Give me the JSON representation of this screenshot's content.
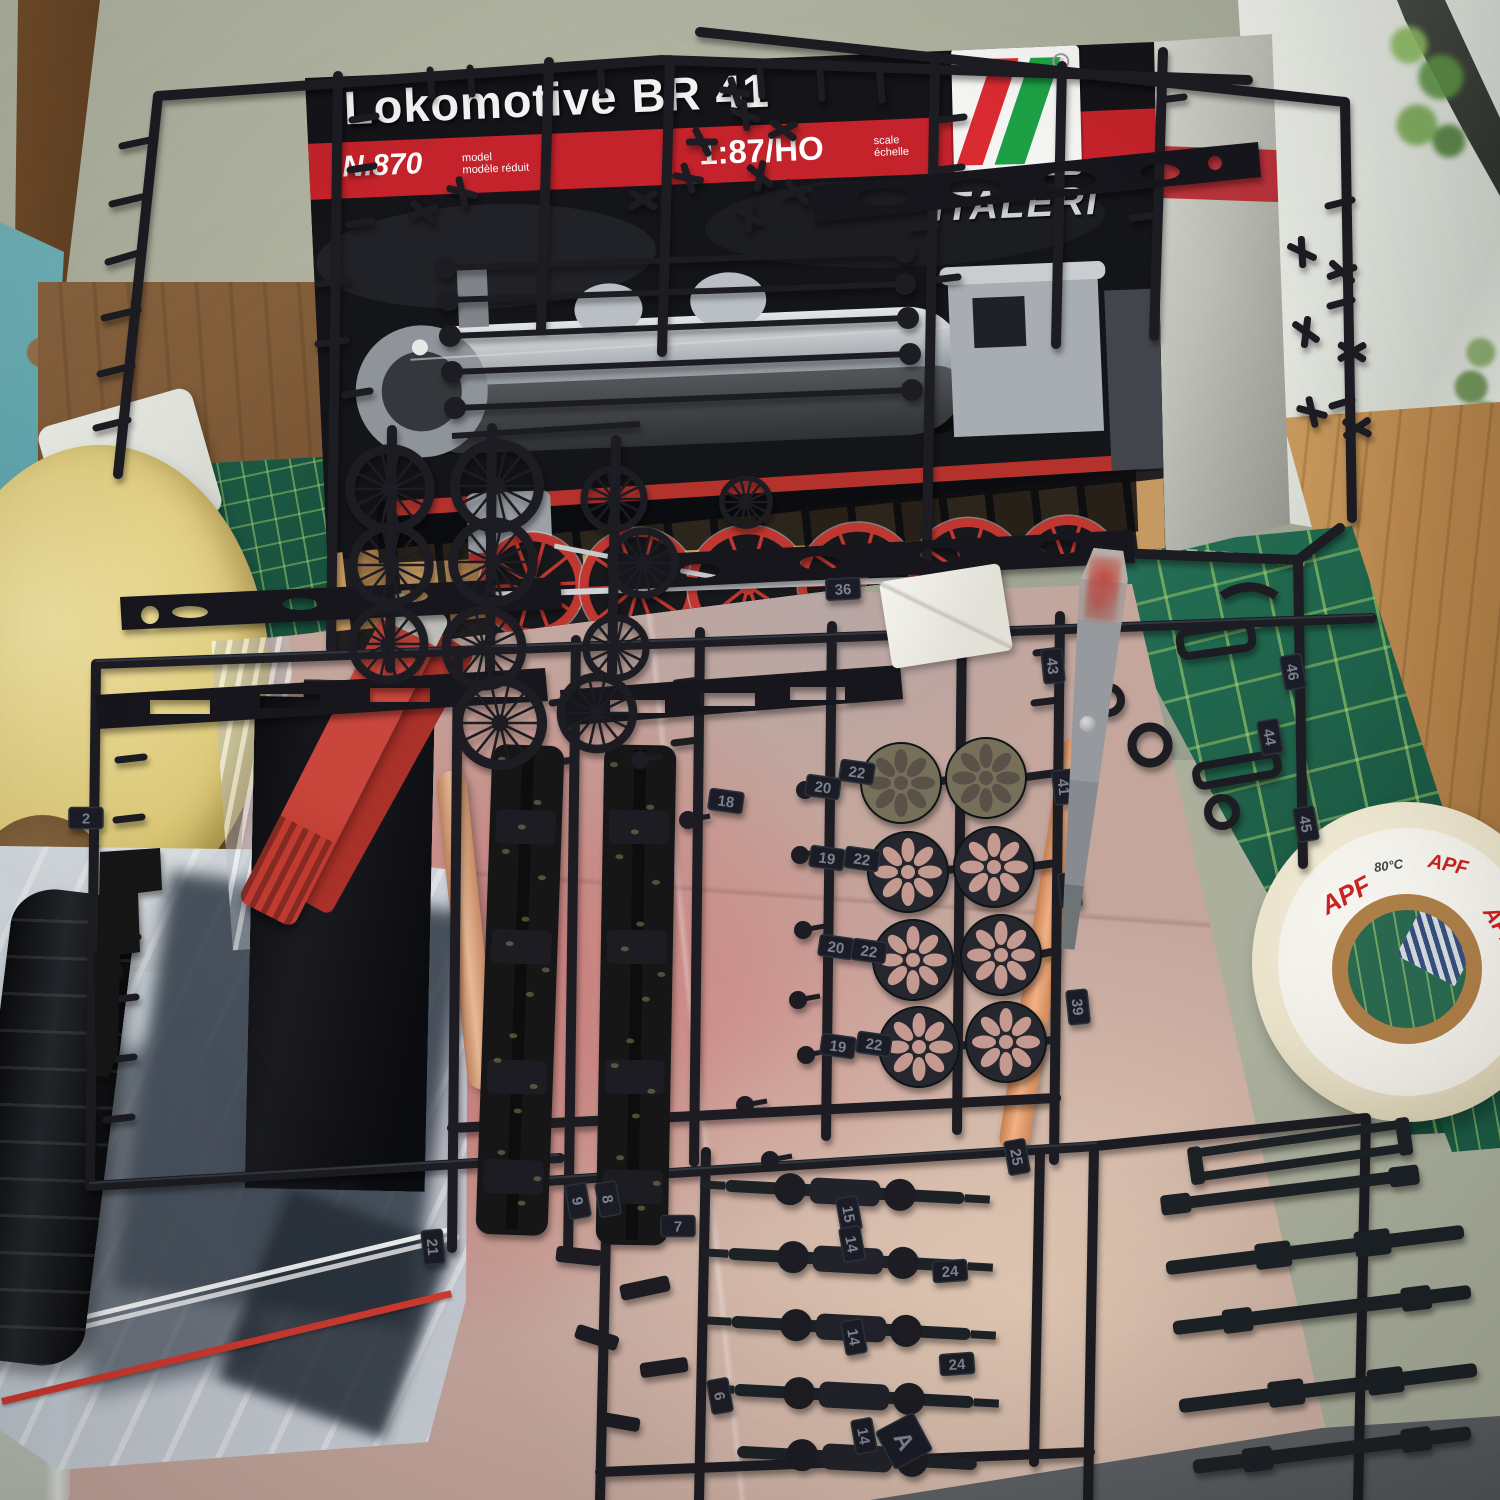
{
  "scene": {
    "type": "photograph",
    "description": "Italeri Lokomotive BR 41 1:87 HO model kit box with black plastic sprues, parts bag, clothes peg, dowels and masking tape rolls on a workbench cutting mat beside a window"
  },
  "box": {
    "title": "Lokomotive BR 41",
    "item_no": "N.870",
    "item_note_line1": "model",
    "item_note_line2": "modèle réduit",
    "scale": "1:87/HO",
    "scale_note_line1": "scale",
    "scale_note_line2": "échelle",
    "brand": "ITALERI"
  },
  "tape": {
    "brand": "APF",
    "temp": "80°C"
  },
  "palette": {
    "sprue": "#1a1d24",
    "sprue_dark": "#15171c",
    "tag_face": "#1b1e25",
    "tag_edge": "#2c313a",
    "tag_text": "#7a828e",
    "box_black": "#141419",
    "stripe_red": "#c4232b",
    "logo_red": "#d92b31",
    "logo_green": "#1da045",
    "mat_green": "#20644d",
    "cardboard": "#c4a69d",
    "disc_dark": "#26282e",
    "disc_worn": "#76705a",
    "petal_pink": "#c49a90",
    "petal_shadow": "#5a5148"
  },
  "parts": {
    "tags": [
      {
        "t": "36",
        "x": 843,
        "y": 589,
        "r": -3
      },
      {
        "t": "18",
        "x": 726,
        "y": 801,
        "r": 8
      },
      {
        "t": "20",
        "x": 823,
        "y": 787,
        "r": 8
      },
      {
        "t": "22",
        "x": 857,
        "y": 772,
        "r": 8
      },
      {
        "t": "19",
        "x": 827,
        "y": 858,
        "r": 8
      },
      {
        "t": "22",
        "x": 862,
        "y": 859,
        "r": 8
      },
      {
        "t": "20",
        "x": 836,
        "y": 947,
        "r": 8
      },
      {
        "t": "22",
        "x": 869,
        "y": 951,
        "r": 8
      },
      {
        "t": "19",
        "x": 838,
        "y": 1046,
        "r": 8
      },
      {
        "t": "22",
        "x": 874,
        "y": 1044,
        "r": 8
      },
      {
        "t": "41",
        "x": 1064,
        "y": 787,
        "r": 84
      },
      {
        "t": "42",
        "x": 1070,
        "y": 890,
        "r": 84
      },
      {
        "t": "39",
        "x": 1078,
        "y": 1007,
        "r": 84
      },
      {
        "t": "43",
        "x": 1053,
        "y": 666,
        "r": 84
      },
      {
        "t": "46",
        "x": 1293,
        "y": 672,
        "r": 80
      },
      {
        "t": "44",
        "x": 1270,
        "y": 737,
        "r": 80
      },
      {
        "t": "45",
        "x": 1306,
        "y": 824,
        "r": 80
      },
      {
        "t": "25",
        "x": 1017,
        "y": 1157,
        "r": 80
      },
      {
        "t": "15",
        "x": 849,
        "y": 1214,
        "r": 80
      },
      {
        "t": "14",
        "x": 852,
        "y": 1244,
        "r": 80
      },
      {
        "t": "14",
        "x": 854,
        "y": 1337,
        "r": 80
      },
      {
        "t": "14",
        "x": 864,
        "y": 1436,
        "r": 80
      },
      {
        "t": "24",
        "x": 950,
        "y": 1271,
        "r": -4
      },
      {
        "t": "24",
        "x": 957,
        "y": 1364,
        "r": -4
      },
      {
        "t": "21",
        "x": 433,
        "y": 1247,
        "r": 85
      },
      {
        "t": "7",
        "x": 678,
        "y": 1226,
        "r": 0
      },
      {
        "t": "2",
        "x": 86,
        "y": 818,
        "r": 0
      },
      {
        "t": "6",
        "x": 720,
        "y": 1396,
        "r": 80
      },
      {
        "t": "9",
        "x": 578,
        "y": 1201,
        "r": 80
      },
      {
        "t": "8",
        "x": 608,
        "y": 1199,
        "r": 80
      },
      {
        "t": "A",
        "x": 904,
        "y": 1441,
        "r": 62,
        "big": true
      }
    ],
    "wheels": [
      {
        "x": 390,
        "y": 489,
        "r": 40
      },
      {
        "x": 497,
        "y": 486,
        "r": 42
      },
      {
        "x": 391,
        "y": 565,
        "r": 38
      },
      {
        "x": 493,
        "y": 562,
        "r": 40
      },
      {
        "x": 614,
        "y": 499,
        "r": 30
      },
      {
        "x": 643,
        "y": 563,
        "r": 32
      },
      {
        "x": 746,
        "y": 502,
        "r": 24
      },
      {
        "x": 388,
        "y": 644,
        "r": 36
      },
      {
        "x": 484,
        "y": 648,
        "r": 38
      },
      {
        "x": 616,
        "y": 648,
        "r": 30
      },
      {
        "x": 500,
        "y": 723,
        "r": 42
      },
      {
        "x": 597,
        "y": 713,
        "r": 36
      }
    ],
    "discs": [
      {
        "x": 901,
        "y": 783,
        "r": 40,
        "v": "worn"
      },
      {
        "x": 986,
        "y": 778,
        "r": 40,
        "v": "worn"
      },
      {
        "x": 908,
        "y": 872,
        "r": 40,
        "v": "dark"
      },
      {
        "x": 994,
        "y": 867,
        "r": 40,
        "v": "dark"
      },
      {
        "x": 913,
        "y": 960,
        "r": 40,
        "v": "dark"
      },
      {
        "x": 1001,
        "y": 955,
        "r": 40,
        "v": "dark"
      },
      {
        "x": 919,
        "y": 1047,
        "r": 40,
        "v": "dark"
      },
      {
        "x": 1006,
        "y": 1042,
        "r": 40,
        "v": "dark"
      }
    ],
    "xparts": [
      [
        745,
        115,
        20
      ],
      [
        783,
        130,
        -25
      ],
      [
        760,
        176,
        40
      ],
      [
        797,
        192,
        -15
      ],
      [
        749,
        216,
        30
      ],
      [
        688,
        178,
        10
      ],
      [
        643,
        200,
        -30
      ],
      [
        462,
        192,
        15
      ],
      [
        423,
        212,
        -20
      ],
      [
        702,
        142,
        0
      ],
      [
        1302,
        252,
        25
      ],
      [
        1342,
        272,
        -20
      ],
      [
        1306,
        332,
        35
      ],
      [
        1352,
        352,
        -30
      ],
      [
        1312,
        412,
        15
      ],
      [
        1357,
        428,
        -35
      ],
      [
        735,
        92,
        10
      ]
    ],
    "pins": [
      [
        805,
        790
      ],
      [
        800,
        855
      ],
      [
        803,
        930
      ],
      [
        798,
        1000
      ],
      [
        806,
        1055
      ],
      [
        745,
        1105
      ],
      [
        688,
        820
      ],
      [
        770,
        1160
      ],
      [
        640,
        760
      ]
    ]
  }
}
